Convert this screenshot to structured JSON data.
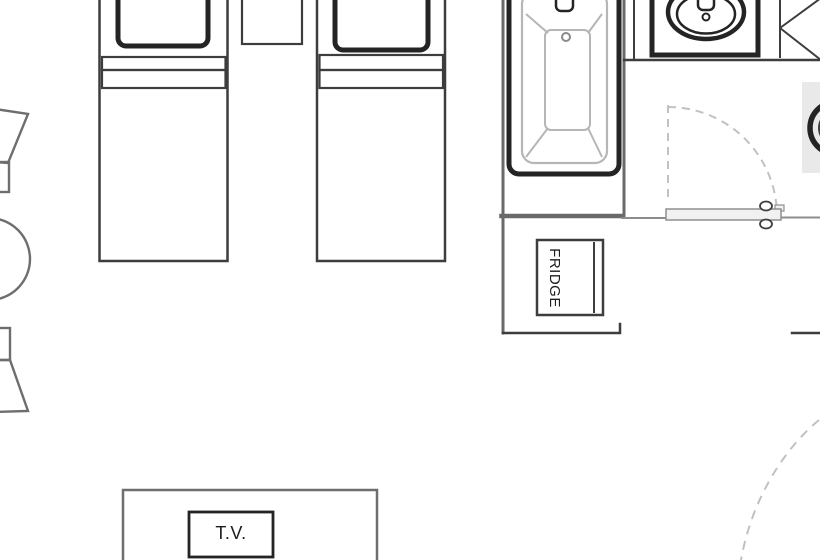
{
  "labels": {
    "fridge": "FRIDGE",
    "tv": "T.V."
  },
  "fixture_icons": [
    "twin-bed-icon",
    "twin-bed-icon",
    "pillow-icon",
    "pillow-icon",
    "nightstand-icon",
    "bathtub-icon",
    "tub-faucet-icon",
    "drain-icon",
    "vanity-sink-icon",
    "sink-faucet-icon",
    "corner-shelf-icon",
    "toilet-icon",
    "swing-door-icon",
    "door-knob-icon",
    "door-swing-arc-icon",
    "fridge-icon",
    "tv-cabinet-icon",
    "television-icon",
    "round-table-icon",
    "chair-icon",
    "chair-icon"
  ],
  "colors": {
    "background": "#ffffff",
    "wall": "#6a6a6a",
    "wall-thin": "#8d8d8d",
    "line-dark": "#242424",
    "line-medium": "#3d3d3d",
    "line-soft": "#6e6e6e",
    "tub-detail": "#b6b6b6",
    "dashed": "#c1c1c1",
    "shade": "#e9e9e9",
    "door-fill": "#f1f1f1",
    "text": "#1c1c1c"
  }
}
